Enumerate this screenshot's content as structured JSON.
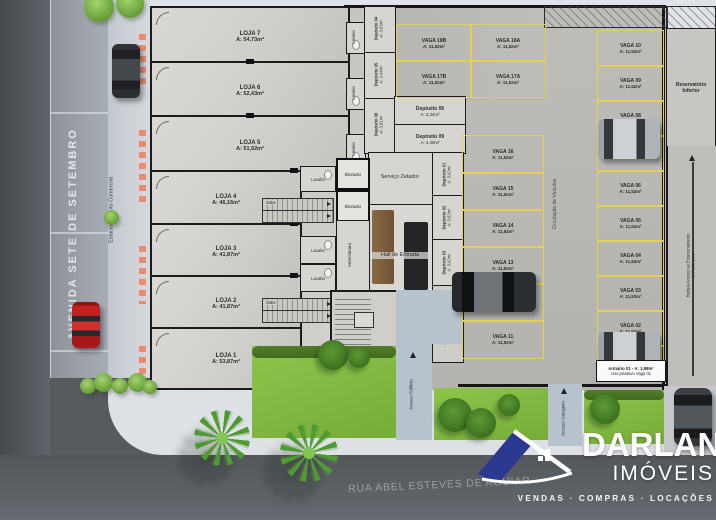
{
  "streets": {
    "avenue": "AVENIDA SETE DE SETEMBRO",
    "street": "RUA ABEL ESTEVES DE AGUIAR",
    "parking_lane": "Estacionamento Comercial"
  },
  "logo": {
    "brand": "DARLAN",
    "kind": "IMÓVEIS",
    "tagline": "VENDAS · COMPRAS · LOCAÇÕES",
    "blue": "#2b3990"
  },
  "lojas": [
    {
      "label": "LOJA 7",
      "area": "A: 54,73m²"
    },
    {
      "label": "LOJA 6",
      "area": "A: 52,43m²"
    },
    {
      "label": "LOJA 5",
      "area": "A: 51,92m²"
    },
    {
      "label": "LOJA 4",
      "area": "A: 46,16m²"
    },
    {
      "label": "LOJA 3",
      "area": "A: 41,87m²"
    },
    {
      "label": "LOJA 2",
      "area": "A: 41,87m²"
    },
    {
      "label": "LOJA 1",
      "area": "A: 53,87m²"
    }
  ],
  "core": {
    "zelador": "Serviço Zelador",
    "hall": "Hall de Entrada",
    "escada": "Escada",
    "elevador": "Elevador",
    "antecamara": "Antecâmara",
    "lavabo": "Lavabo",
    "sobe": "Sobe",
    "medidores": "Medidores de Energia"
  },
  "depositos": [
    {
      "label": "Depósito 01",
      "area": "A: 3,62m²"
    },
    {
      "label": "Depósito 02",
      "area": "A: 3,62m²"
    },
    {
      "label": "Depósito 03",
      "area": "A: 3,62m²"
    },
    {
      "label": "Depósito 04",
      "area": "A: 3,63m²"
    },
    {
      "label": "Depósito 05",
      "area": "A: 3,44m²"
    },
    {
      "label": "Depósito 08",
      "area": "A: 3,91m²"
    },
    {
      "label": "Depósito 06",
      "area": "A: 4,34m²"
    },
    {
      "label": "Depósito 09",
      "area": "A: 4,40m²"
    }
  ],
  "parking": {
    "circulation": "Circulação de Veículos",
    "top": [
      {
        "label": "VAGA 18B",
        "area": "A: 11,52m²"
      },
      {
        "label": "VAGA 18A",
        "area": "A: 11,52m²"
      },
      {
        "label": "VAGA 17B",
        "area": "A: 11,52m²"
      },
      {
        "label": "VAGA 17A",
        "area": "A: 11,52m²"
      }
    ],
    "middle": [
      {
        "label": "VAGA 16",
        "area": "A: 11,52m²"
      },
      {
        "label": "VAGA 15",
        "area": "A: 11,52m²"
      },
      {
        "label": "VAGA 14",
        "area": "A: 11,52m²"
      },
      {
        "label": "VAGA 13",
        "area": "A: 11,52m²"
      },
      {
        "label": "VAGA 12",
        "area": "A: 11,52m²"
      },
      {
        "label": "VAGA 11",
        "area": "A: 11,52m²"
      }
    ],
    "right": [
      {
        "label": "VAGA 10",
        "area": "A: 11,52m²"
      },
      {
        "label": "VAGA 09",
        "area": "A: 11,52m²"
      },
      {
        "label": "VAGA 08",
        "area": "A: 11,52m²"
      },
      {
        "label": "VAGA 07",
        "area": "A: 11,52m²"
      },
      {
        "label": "VAGA 06",
        "area": "A: 11,52m²"
      },
      {
        "label": "VAGA 05",
        "area": "A: 11,52m²"
      },
      {
        "label": "VAGA 04",
        "area": "A: 11,52m²"
      },
      {
        "label": "VAGA 03",
        "area": "A: 11,52m²"
      },
      {
        "label": "VAGA 02",
        "area": "A: 11,52m²"
      },
      {
        "label": "VAGA 01",
        "area": "A: 11,52m²"
      }
    ]
  },
  "right_wing": {
    "reservoir_1": "Reservatório",
    "reservoir_2": "Inferior",
    "ramp_1": "Rampa Acesso ao Estacionamento",
    "ramp_2": "2º Pavimento",
    "cabinet_1": "Armário 01 - A: 1,98m²",
    "cabinet_2": "Uso privativo Vaga 01"
  },
  "access": {
    "building": "Acesso Edifício",
    "garage": "Acesso Garagem"
  }
}
